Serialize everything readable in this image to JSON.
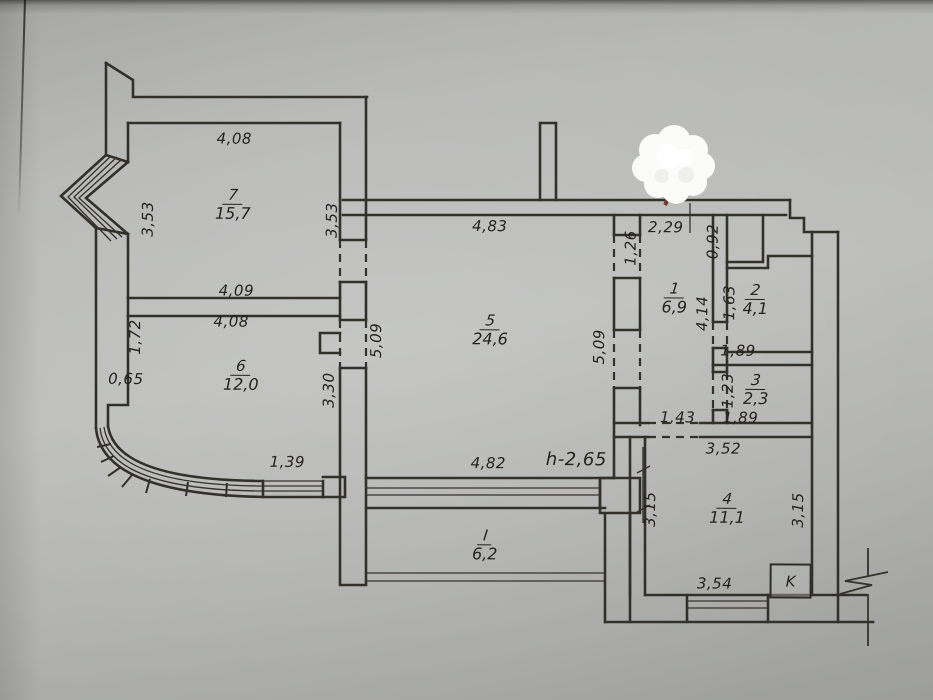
{
  "document": {
    "kind": "apartment floor plan photo",
    "line_color": "#32302b",
    "paper_color": "#b6b7b5"
  },
  "rooms": [
    {
      "number": "7",
      "area": "15,7",
      "x": 232,
      "y": 206
    },
    {
      "number": "6",
      "area": "12,0",
      "x": 241,
      "y": 377
    },
    {
      "number": "5",
      "area": "24,6",
      "x": 490,
      "y": 330
    },
    {
      "number": "1",
      "area": "6,9",
      "x": 674,
      "y": 297
    },
    {
      "number": "2",
      "area": "4,1",
      "x": 755,
      "y": 298
    },
    {
      "number": "3",
      "area": "2,3",
      "x": 756,
      "y": 388
    },
    {
      "number": "4",
      "area": "11,1",
      "x": 728,
      "y": 507
    },
    {
      "number": "I",
      "area": "6,2",
      "x": 486,
      "y": 545
    }
  ],
  "dimensions": [
    {
      "text": "4,08",
      "x": 233,
      "y": 140,
      "rot": false
    },
    {
      "text": "3,53",
      "x": 147,
      "y": 221,
      "rot": true
    },
    {
      "text": "3,53",
      "x": 331,
      "y": 221,
      "rot": true
    },
    {
      "text": "4,09",
      "x": 236,
      "y": 292,
      "rot": false
    },
    {
      "text": "4,08",
      "x": 231,
      "y": 323,
      "rot": false
    },
    {
      "text": "1,72",
      "x": 135,
      "y": 339,
      "rot": true
    },
    {
      "text": "0,65",
      "x": 126,
      "y": 381,
      "rot": false
    },
    {
      "text": "3,30",
      "x": 329,
      "y": 391,
      "rot": true
    },
    {
      "text": "1,39",
      "x": 288,
      "y": 463,
      "rot": false
    },
    {
      "text": "4,83",
      "x": 489,
      "y": 226,
      "rot": false
    },
    {
      "text": "5,09",
      "x": 376,
      "y": 341,
      "rot": true
    },
    {
      "text": "5,09",
      "x": 599,
      "y": 346,
      "rot": true
    },
    {
      "text": "4,82",
      "x": 489,
      "y": 463,
      "rot": false
    },
    {
      "text": "2,29",
      "x": 665,
      "y": 226,
      "rot": false
    },
    {
      "text": "1,26",
      "x": 630,
      "y": 247,
      "rot": true
    },
    {
      "text": "0,92",
      "x": 712,
      "y": 240,
      "rot": true
    },
    {
      "text": "4,14",
      "x": 702,
      "y": 312,
      "rot": true
    },
    {
      "text": "1,63",
      "x": 729,
      "y": 301,
      "rot": true
    },
    {
      "text": "1,89",
      "x": 738,
      "y": 349,
      "rot": false
    },
    {
      "text": "1,23",
      "x": 728,
      "y": 389,
      "rot": true
    },
    {
      "text": "1,89",
      "x": 741,
      "y": 416,
      "rot": false
    },
    {
      "text": "1,43",
      "x": 678,
      "y": 416,
      "rot": false
    },
    {
      "text": "3,52",
      "x": 724,
      "y": 447,
      "rot": false
    },
    {
      "text": "3,15",
      "x": 651,
      "y": 508,
      "rot": true
    },
    {
      "text": "3,15",
      "x": 799,
      "y": 508,
      "rot": true
    },
    {
      "text": "3,54",
      "x": 716,
      "y": 582,
      "rot": false
    }
  ],
  "annotations": {
    "height_note": "h-2,65",
    "shaft_label": "K"
  }
}
